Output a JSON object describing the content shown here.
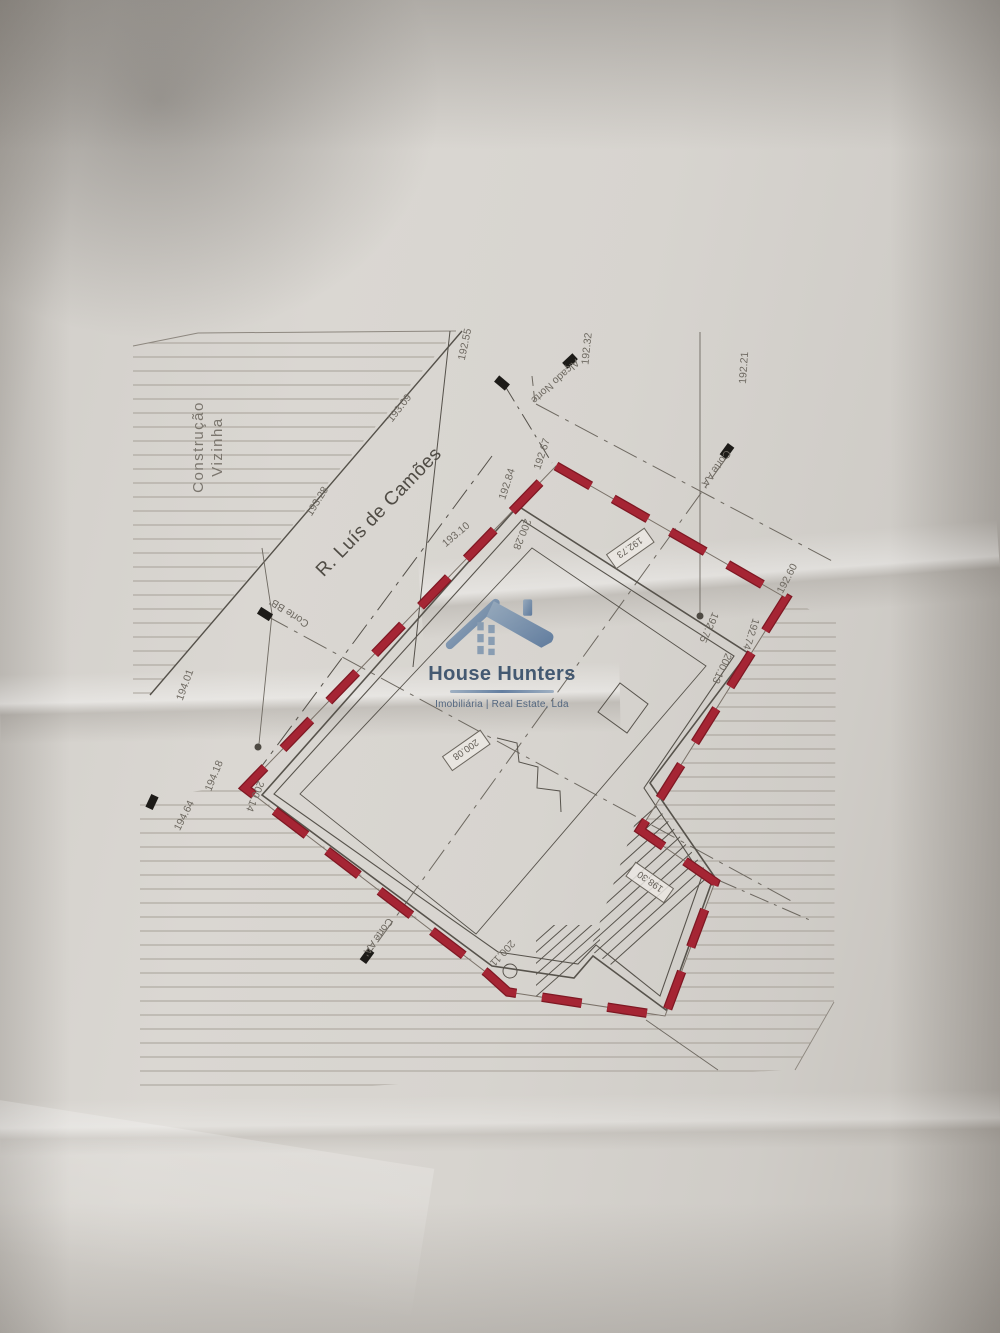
{
  "watermark": {
    "brand": "House Hunters",
    "tagline": "Imobiliária | Real Estate, Lda",
    "icon": "house-logo-icon"
  },
  "colors": {
    "boundary_red": "#a52534",
    "boundary_red_dark": "#7e1823",
    "drawing_line": "#57534c",
    "hatch_line": "#a19b92",
    "label_text": "#6e6961",
    "logo_navy": "#27415f",
    "logo_steel": "#5b7fa6",
    "paper": "#d7d4cf"
  },
  "plan": {
    "labels": [
      {
        "n": "neighbor-construction-label-line1",
        "t": "Construção",
        "x": 203,
        "y": 447,
        "r": -90,
        "c": "big"
      },
      {
        "n": "neighbor-construction-label-line2",
        "t": "Vizinha",
        "x": 222,
        "y": 447,
        "r": -90,
        "c": "big"
      },
      {
        "n": "street-name-label",
        "t": "R. Luís de Camões",
        "x": 383,
        "y": 516,
        "r": -46,
        "c": "street"
      },
      {
        "n": "elevation-label",
        "t": "192.55",
        "x": 468,
        "y": 345,
        "r": -78
      },
      {
        "n": "elevation-label",
        "t": "193.09",
        "x": 402,
        "y": 410,
        "r": -52
      },
      {
        "n": "elevation-label",
        "t": "193.28",
        "x": 320,
        "y": 503,
        "r": -58
      },
      {
        "n": "elevation-label",
        "t": "193.10",
        "x": 458,
        "y": 537,
        "r": -40
      },
      {
        "n": "elevation-label",
        "t": "192.84",
        "x": 510,
        "y": 485,
        "r": -72
      },
      {
        "n": "elevation-label",
        "t": "192.67",
        "x": 545,
        "y": 455,
        "r": -72
      },
      {
        "n": "elevation-label",
        "t": "192.32",
        "x": 590,
        "y": 349,
        "r": -84
      },
      {
        "n": "elevation-label",
        "t": "192.21",
        "x": 747,
        "y": 368,
        "r": -86
      },
      {
        "n": "elevation-label",
        "t": "192.60",
        "x": 790,
        "y": 580,
        "r": -62
      },
      {
        "n": "elevation-label",
        "t": "192.75",
        "x": 706,
        "y": 626,
        "r": 115
      },
      {
        "n": "elevation-label",
        "t": "192.74",
        "x": 748,
        "y": 633,
        "r": 108
      },
      {
        "n": "elevation-label",
        "t": "200.13",
        "x": 719,
        "y": 667,
        "r": 115
      },
      {
        "n": "elevation-label",
        "t": "200.28",
        "x": 519,
        "y": 533,
        "r": 112
      },
      {
        "n": "elevation-label",
        "t": "200.14",
        "x": 252,
        "y": 795,
        "r": 112
      },
      {
        "n": "elevation-label",
        "t": "194.01",
        "x": 188,
        "y": 686,
        "r": -70
      },
      {
        "n": "elevation-label",
        "t": "194.18",
        "x": 217,
        "y": 777,
        "r": -68
      },
      {
        "n": "elevation-label",
        "t": "194.64",
        "x": 187,
        "y": 817,
        "r": -63
      },
      {
        "n": "elevation-label",
        "t": "200.11",
        "x": 500,
        "y": 951,
        "r": 133,
        "s": 9
      },
      {
        "n": "north-elevation-marker-label",
        "t": "Alçado Norte",
        "x": 553,
        "y": 379,
        "r": 138
      },
      {
        "n": "section-aa-label-top",
        "t": "Corte AA'",
        "x": 713,
        "y": 467,
        "r": 126
      },
      {
        "n": "section-aa-label-bottom",
        "t": "Corte AA'",
        "x": 375,
        "y": 935,
        "r": 126
      },
      {
        "n": "section-bb-label",
        "t": "Corte BB'",
        "x": 291,
        "y": 610,
        "r": -147
      }
    ],
    "boxed_labels": [
      {
        "n": "boxed-elevation-label",
        "t": "192.73",
        "x": 630,
        "y": 548,
        "r": 145
      },
      {
        "n": "boxed-elevation-label",
        "t": "200.08",
        "x": 466,
        "y": 750,
        "r": 145
      },
      {
        "n": "boxed-elevation-label",
        "t": "198.30",
        "x": 650,
        "y": 882,
        "r": 215
      }
    ],
    "survey_flags": [
      {
        "x": 502,
        "y": 383,
        "r": 40
      },
      {
        "x": 570,
        "y": 361,
        "r": 137
      },
      {
        "x": 727,
        "y": 451,
        "r": 126
      },
      {
        "x": 265,
        "y": 614,
        "r": -148
      },
      {
        "x": 367,
        "y": 956,
        "r": 126
      },
      {
        "x": 152,
        "y": 802,
        "r": -65
      }
    ],
    "survey_dots": [
      {
        "x": 700,
        "y": 616
      },
      {
        "x": 258,
        "y": 747
      }
    ],
    "corner_circle": {
      "x": 510,
      "y": 971,
      "rad": 7
    }
  }
}
